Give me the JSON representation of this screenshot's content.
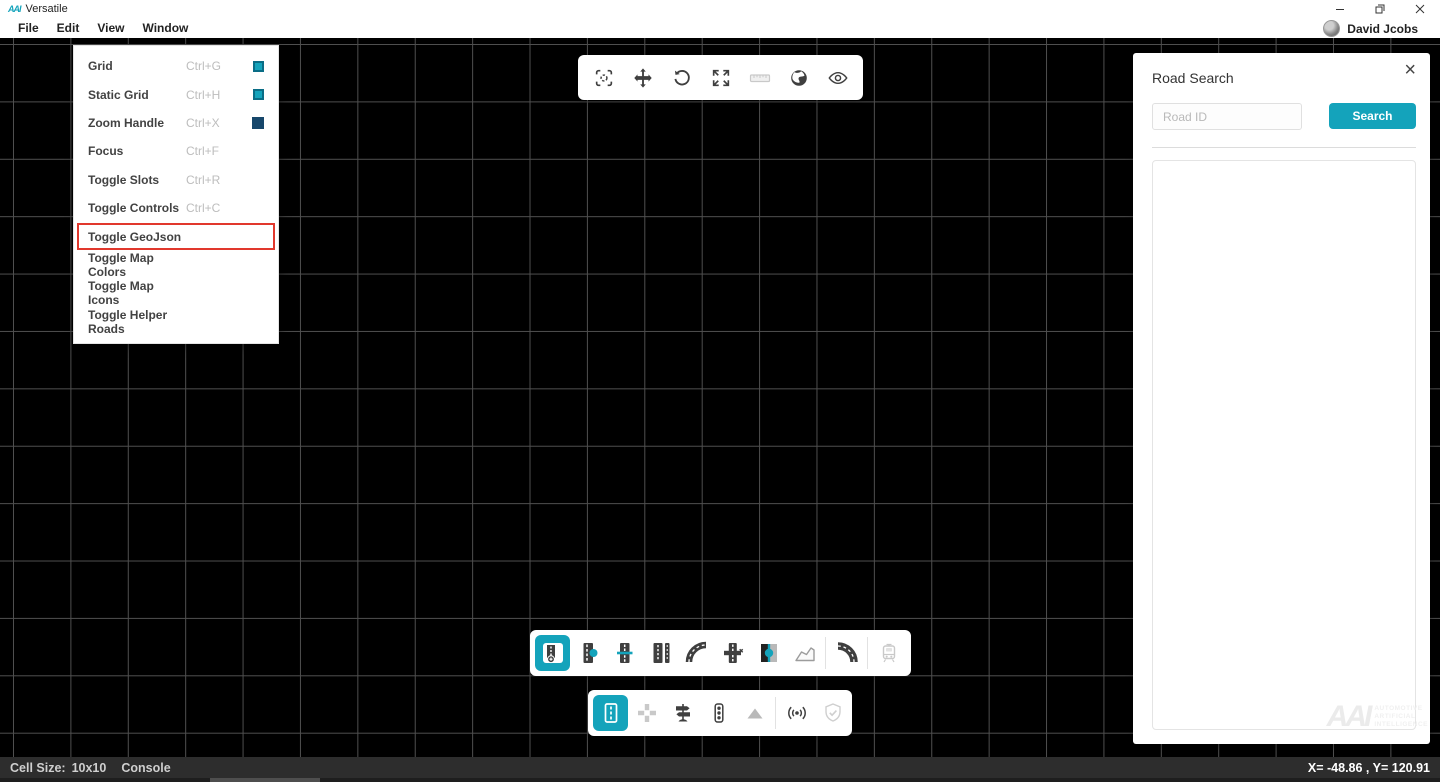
{
  "colors": {
    "accent": "#14a3bb",
    "accent_dark": "#0a6d86",
    "navy": "#17476b",
    "red": "#e1382d",
    "icon": "#3f3f3f",
    "disabled": "#c9c9c9",
    "grid_line": "#4f4f4f",
    "status_bg": "#2d2d2d"
  },
  "titlebar": {
    "logo": "AAI",
    "title": "Versatile"
  },
  "window_controls": {
    "minimize": "–",
    "restore": "restore",
    "close": "×"
  },
  "menubar": {
    "items": [
      "File",
      "Edit",
      "View",
      "Window"
    ],
    "user_name": "David Jcobs"
  },
  "view_menu": {
    "items": [
      {
        "label": "Grid",
        "shortcut": "Ctrl+G",
        "checkbox": "teal",
        "highlighted": false
      },
      {
        "label": "Static Grid",
        "shortcut": "Ctrl+H",
        "checkbox": "teal",
        "highlighted": false
      },
      {
        "label": "Zoom Handle",
        "shortcut": "Ctrl+X",
        "checkbox": "navy",
        "highlighted": false
      },
      {
        "label": "Focus",
        "shortcut": "Ctrl+F",
        "checkbox": "none",
        "highlighted": false
      },
      {
        "label": "Toggle Slots",
        "shortcut": "Ctrl+R",
        "checkbox": "none",
        "highlighted": false
      },
      {
        "label": "Toggle Controls",
        "shortcut": "Ctrl+C",
        "checkbox": "none",
        "highlighted": false
      },
      {
        "label": "Toggle GeoJson",
        "shortcut": "",
        "checkbox": "none",
        "highlighted": true
      },
      {
        "label": "Toggle Map Colors",
        "shortcut": "",
        "checkbox": "none",
        "highlighted": false
      },
      {
        "label": "Toggle Map Icons",
        "shortcut": "",
        "checkbox": "none",
        "highlighted": false
      },
      {
        "label": "Toggle Helper Roads",
        "shortcut": "",
        "checkbox": "none",
        "highlighted": false
      }
    ]
  },
  "top_toolbar": {
    "items": [
      "focus-center",
      "move",
      "rotate",
      "expand",
      "ruler",
      "globe",
      "visibility"
    ],
    "disabled": [
      "ruler"
    ]
  },
  "road_search": {
    "title": "Road Search",
    "input_placeholder": "Road ID",
    "input_value": "",
    "search_label": "Search"
  },
  "road_toolbar": {
    "items": [
      "add-road",
      "road-connector",
      "road-split",
      "road-lanes",
      "curved-road",
      "road-cross-delete",
      "road-merge",
      "area-polygon",
      "curved-road-bold",
      "tram"
    ],
    "selected": "add-road",
    "disabled": [
      "tram"
    ]
  },
  "object_toolbar": {
    "items": [
      "road",
      "intersection",
      "signpost",
      "traffic-light",
      "terrain",
      "signal",
      "shield-check"
    ],
    "selected": "road",
    "disabled": [
      "intersection",
      "terrain",
      "shield-check"
    ]
  },
  "statusbar": {
    "cell_size_label": "Cell Size:",
    "cell_size_value": "10x10",
    "console_label": "Console",
    "coordinates": "X= -48.86 , Y= 120.91"
  },
  "canvas": {
    "grid_cell_px": 57.4
  },
  "watermark": {
    "logo": "AAI",
    "lines": [
      "AUTOMOTIVE",
      "ARTIFICIAL",
      "INTELLIGENCE"
    ]
  }
}
